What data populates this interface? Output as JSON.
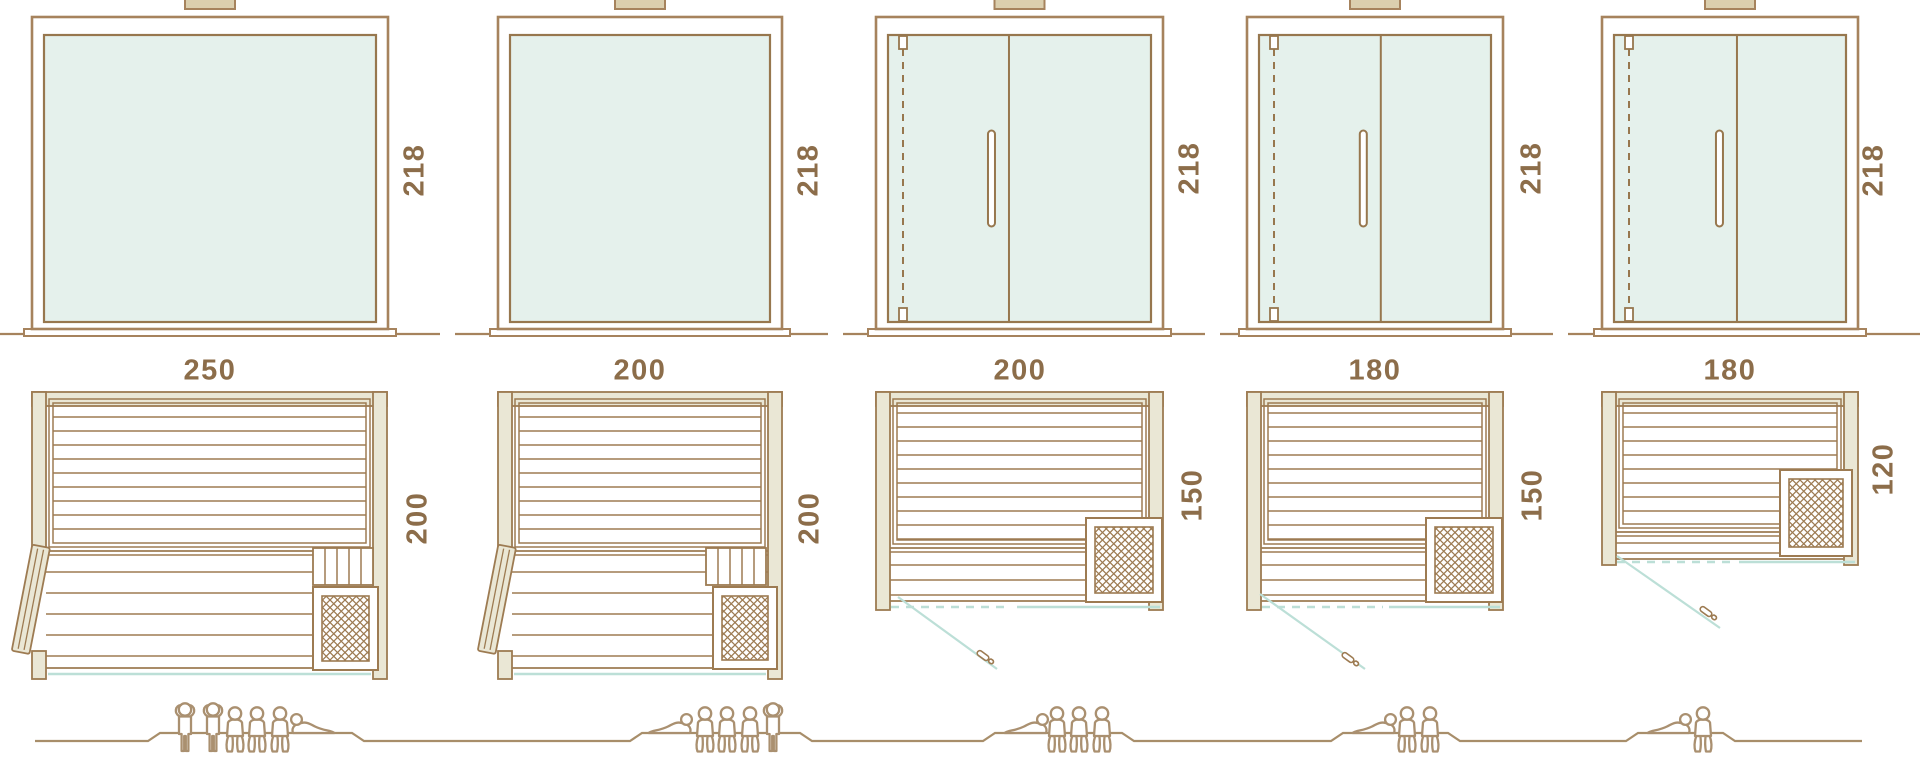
{
  "diagram": {
    "colors": {
      "outline": "#9d7b52",
      "frame": "#a6835d",
      "glass_fill": "#e5f1ec",
      "glass_stroke": "#97774e",
      "wall_fill": "#eae7d5",
      "teal": "#bcdfd7",
      "label_text": "#8c6d4a",
      "people": "#aa9070",
      "ground": "#a88e6a",
      "vent": "#dbcfae"
    },
    "saunas": [
      {
        "name": "sauna-250x200",
        "front_width_label": "250",
        "front_height_label": "218",
        "plan_depth_label": "200",
        "front_type": "fixed-glass-panel",
        "door": "hinged-wood-door-on-left-side",
        "heater_position": "front-right",
        "capacity": 6,
        "capacity_figures": [
          "standing",
          "standing",
          "seated",
          "seated",
          "seated",
          "lying-head-left"
        ]
      },
      {
        "name": "sauna-200x200",
        "front_width_label": "200",
        "front_height_label": "218",
        "plan_depth_label": "200",
        "front_type": "fixed-glass-panel",
        "door": "hinged-wood-door-on-left-side",
        "heater_position": "front-right",
        "capacity": 5,
        "capacity_figures": [
          "lying-head-right",
          "seated",
          "seated",
          "seated",
          "standing"
        ]
      },
      {
        "name": "sauna-200x150",
        "front_width_label": "200",
        "front_height_label": "218",
        "plan_depth_label": "150",
        "front_type": "glass-front-with-hinged-door",
        "door": "glass-door-front-left",
        "heater_position": "front-right",
        "capacity": 4,
        "capacity_figures": [
          "lying-head-right",
          "seated",
          "seated",
          "seated"
        ]
      },
      {
        "name": "sauna-180x150",
        "front_width_label": "180",
        "front_height_label": "218",
        "plan_depth_label": "150",
        "front_type": "glass-front-with-hinged-door",
        "door": "glass-door-front-left",
        "heater_position": "front-right",
        "capacity": 3,
        "capacity_figures": [
          "lying-head-right",
          "seated",
          "seated"
        ]
      },
      {
        "name": "sauna-180x120",
        "front_width_label": "180",
        "front_height_label": "218",
        "plan_depth_label": "120",
        "front_type": "glass-front-with-hinged-door",
        "door": "glass-door-front-left",
        "heater_position": "right",
        "capacity": 2,
        "capacity_figures": [
          "lying-head-right",
          "seated"
        ]
      }
    ],
    "icons": [
      "person-standing-icon",
      "person-seated-icon",
      "person-lying-icon",
      "heater-icon",
      "door-handle-icon",
      "hinge-icon",
      "vent-icon"
    ]
  }
}
